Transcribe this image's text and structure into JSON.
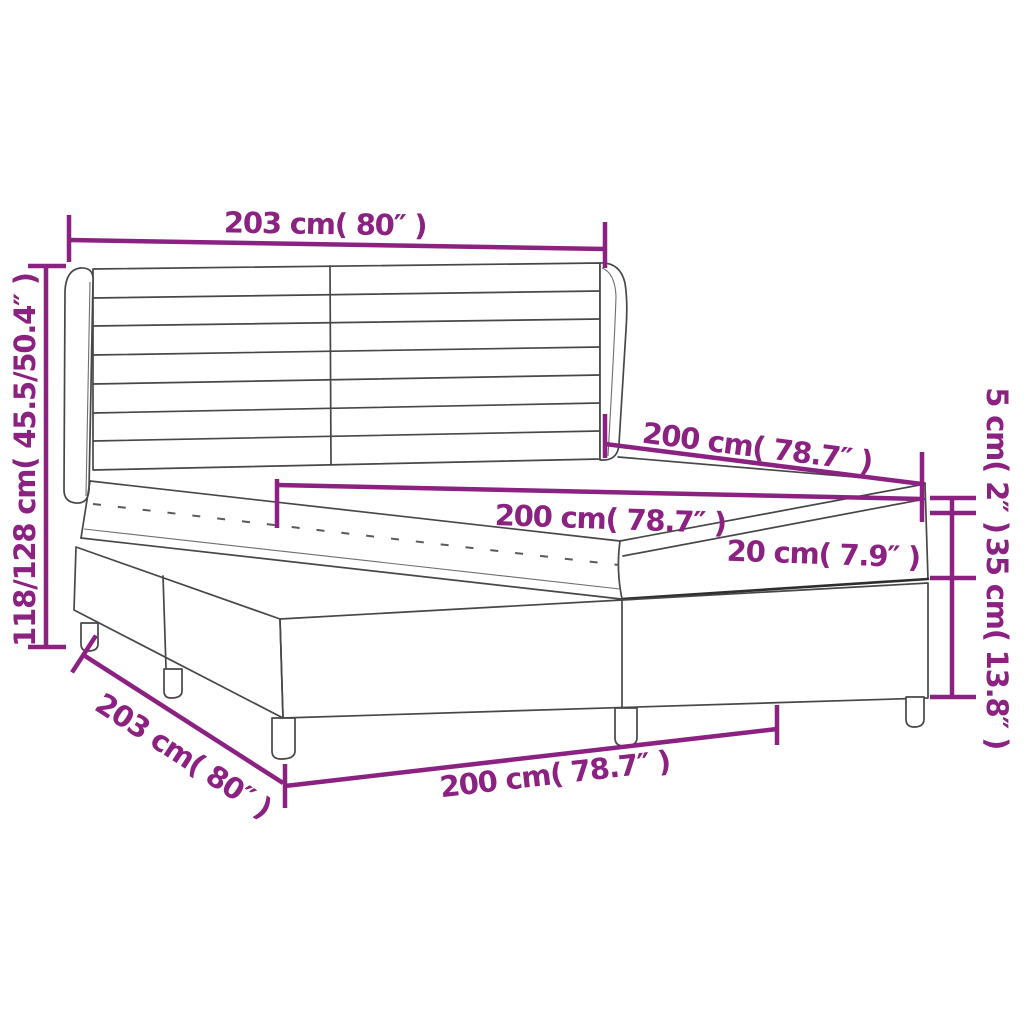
{
  "diagram": {
    "title": "box-spring-bed-dimension-diagram",
    "product": "Box spring bed with winged striped headboard, two-piece base and legs",
    "accent_color": "#8B2180",
    "line_color": "#474747",
    "background_color": "#ffffff",
    "dims": {
      "headboard_width_top": "203 cm( 80″ )",
      "overall_height_left": "118/128 cm( 45.5/50.4″ )",
      "bed_length_upper": "200 cm( 78.7″ )",
      "mattress_width_middle": "200 cm( 78.7″ )",
      "mattress_height": "20 cm( 7.9″ )",
      "topper_height_right": "5 cm( 2″ )",
      "base_height_right": "35 cm( 13.8″ )",
      "base_width_diagonal": "203 cm( 80″ )",
      "base_length_bottom": "200 cm( 78.7″ )"
    }
  }
}
